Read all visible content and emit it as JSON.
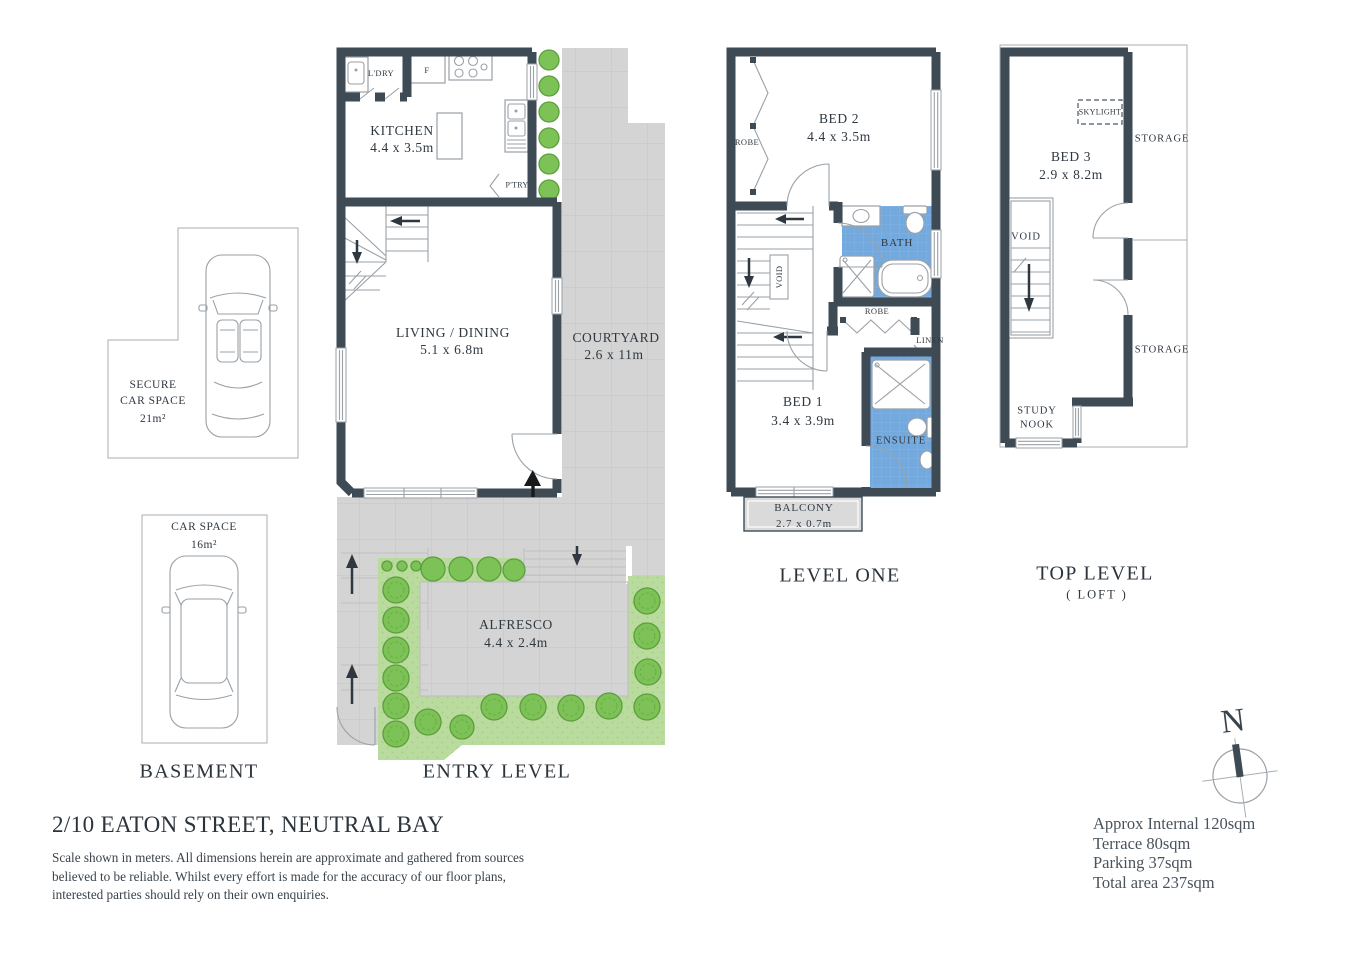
{
  "page": {
    "address": "2/10 EATON STREET, NEUTRAL BAY",
    "disclaimer": "Scale shown in meters. All dimensions herein are approximate and gathered from sources believed to be  reliable. Whilst every effort is made for the accuracy of our floor plans, interested parties should rely on their own enquiries."
  },
  "summary": {
    "internal": "Approx Internal 120sqm",
    "terrace": "Terrace 80sqm",
    "parking": "Parking 37sqm",
    "total": "Total area 237sqm"
  },
  "compass": {
    "north": "N"
  },
  "basement": {
    "title": "BASEMENT",
    "secure_space": {
      "line1": "SECURE",
      "line2": "CAR SPACE",
      "area": "21m²"
    },
    "car_space": {
      "name": "CAR SPACE",
      "area": "16m²"
    }
  },
  "entry_level": {
    "title": "ENTRY LEVEL",
    "laundry": "L'DRY",
    "fridge": "F",
    "pantry": "P'TRY",
    "kitchen": {
      "name": "KITCHEN",
      "dim": "4.4 x 3.5m"
    },
    "living_dining": {
      "name": "LIVING / DINING",
      "dim": "5.1 x 6.8m"
    },
    "courtyard": {
      "name": "COURTYARD",
      "dim": "2.6 x 11m"
    },
    "alfresco": {
      "name": "ALFRESCO",
      "dim": "4.4 x 2.4m"
    }
  },
  "level_one": {
    "title": "LEVEL ONE",
    "bed2": {
      "name": "BED 2",
      "dim": "4.4 x 3.5m"
    },
    "bed1": {
      "name": "BED 1",
      "dim": "3.4 x 3.9m"
    },
    "bath": "BATH",
    "ensuite": "ENSUITE",
    "robe_bed2": "ROBE",
    "robe_hall": "ROBE",
    "linen": "LINEN",
    "void": "VOID",
    "balcony": {
      "name": "BALCONY",
      "dim": "2.7 x 0.7m"
    }
  },
  "top_level": {
    "title": "TOP LEVEL",
    "subtitle": "( LOFT )",
    "bed3": {
      "name": "BED 3",
      "dim": "2.9 x 8.2m"
    },
    "skylight": "SKYLIGHT",
    "storage_upper": "STORAGE",
    "storage_lower": "STORAGE",
    "void": "VOID",
    "study_nook": {
      "line1": "STUDY",
      "line2": "NOOK"
    }
  },
  "colors": {
    "wall": "#3e4b55",
    "paving": "#d4d4d4",
    "garden": "#b9db9d",
    "bush": "#7dc257",
    "bath_blue": "#74a9de",
    "text": "#2f3840"
  }
}
